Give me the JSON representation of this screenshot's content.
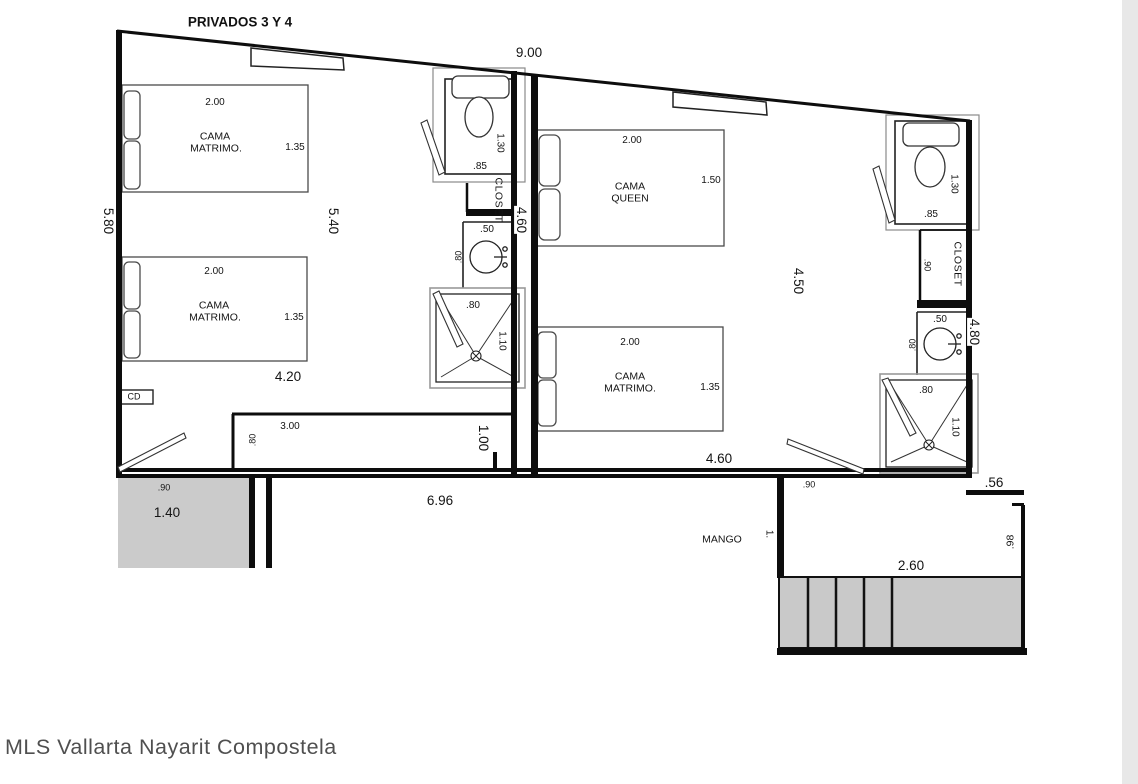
{
  "title": "PRIVADOS 3 Y 4",
  "watermark": "MLS Vallarta Nayarit Compostela",
  "colors": {
    "wall": "#0d0d0d",
    "furniture": "#4a4a4a",
    "fill_gray": "#cbcbcb",
    "page_edge": "#e8e8e8"
  },
  "dims": {
    "top_width": "9.00",
    "left_height": "5.80"
  },
  "room1": {
    "height": "5.40",
    "width": "4.20",
    "bed_top": {
      "label_line1": "CAMA",
      "label_line2": "MATRIMO.",
      "width": "2.00",
      "depth": "1.35"
    },
    "bed_bottom": {
      "label_line1": "CAMA",
      "label_line2": "MATRIMO.",
      "width": "2.00",
      "depth": "1.35"
    },
    "cd_box": "CD",
    "counter": {
      "width": "3.00",
      "depth": ".80",
      "height": "1.00"
    }
  },
  "bath1": {
    "toilet_depth": "1.30",
    "toilet_width": ".85",
    "closet_label": "CLOSET",
    "depth": "4.60",
    "sink_width": ".50",
    "sink_depth": ".80",
    "shower_width": ".80",
    "shower_depth": "1.10"
  },
  "room2": {
    "height": "4.50",
    "width": "4.60",
    "door_width": ".90",
    "bed_queen": {
      "label_line1": "CAMA",
      "label_line2": "QUEEN",
      "width": "2.00",
      "depth": "1.50"
    },
    "bed_matrimonial": {
      "label_line1": "CAMA",
      "label_line2": "MATRIMO.",
      "width": "2.00",
      "depth": "1.35"
    }
  },
  "bath2": {
    "toilet_depth": "1.30",
    "toilet_width": ".85",
    "closet_label": "CLOSET",
    "closet_width": ".90",
    "depth": "4.80",
    "sink_width": ".50",
    "sink_depth": ".80",
    "shower_width": ".80",
    "shower_depth": "1.10",
    "offset": ".56"
  },
  "exterior": {
    "patio_left": {
      "width": ".90",
      "length": "1.40"
    },
    "terrace_width": "6.96",
    "mango_label": "MANGO",
    "mango_width": "1.",
    "stairs_width": "2.60",
    "stairs_depth": ".98"
  }
}
